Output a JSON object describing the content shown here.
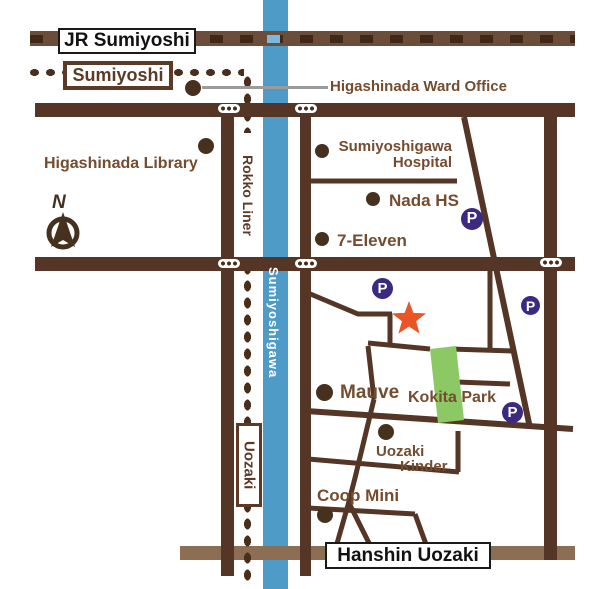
{
  "colors": {
    "road": "#553626",
    "rail_jr": "#6b4d3a",
    "rail_jr_dash": "#3f2817",
    "rail_river_dash": "#7cb8dc",
    "rail_hanshin": "#8c6e55",
    "liner_dot": "#4a2e1c",
    "river": "#4f9bc8",
    "park": "#8cc863",
    "star": "#ea5528",
    "parking": "#3b2a80",
    "poi": "#46311f",
    "label": "#744c30",
    "box_border": "#5d3a26",
    "dark_border": "#1a1a1a",
    "pointer": "#9b9b9b",
    "signal_bg": "#ffffff"
  },
  "stations": {
    "jr_sumiyoshi": "JR Sumiyoshi",
    "sumiyoshi": "Sumiyoshi",
    "hanshin_uozaki": "Hanshin Uozaki"
  },
  "transit": {
    "rokko_liner": "Rokko Liner",
    "uozaki": "Uozaki"
  },
  "river": {
    "name": "Sumiyoshigawa"
  },
  "compass": {
    "label": "N"
  },
  "places": {
    "ward_office": "Higashinada Ward Office",
    "library": "Higashinada Library",
    "hospital_line1": "Sumiyoshigawa",
    "hospital_line2": "Hospital",
    "nada_hs": "Nada HS",
    "seven_eleven": "7-Eleven",
    "mauve": "Mauve",
    "kokita_park": "Kokita Park",
    "kinder_line1": "Uozaki",
    "kinder_line2": "Kinder",
    "coop_mini": "Coop Mini"
  },
  "markers": {
    "parking_label": "P"
  }
}
